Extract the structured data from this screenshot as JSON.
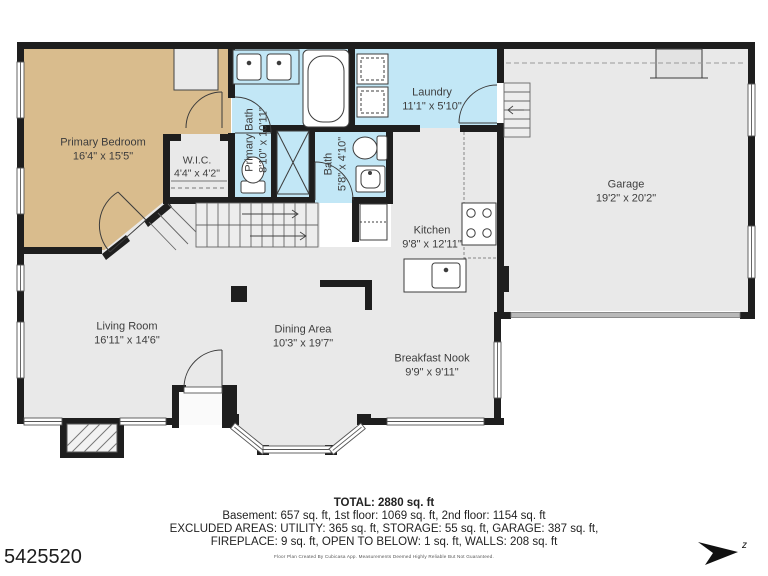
{
  "meta": {
    "mls_number": "5425520",
    "compass_label": "z"
  },
  "rooms": [
    {
      "name": "Primary Bedroom",
      "dims": "16'4\" x 15'5\""
    },
    {
      "name": "W.I.C.",
      "dims": "4'4\" x 4'2\""
    },
    {
      "name": "Primary Bath",
      "dims": "8'10\" x 10'11\""
    },
    {
      "name": "Bath",
      "dims": "5'8\" x 4'10\""
    },
    {
      "name": "Laundry",
      "dims": "11'1\" x 5'10\""
    },
    {
      "name": "Kitchen",
      "dims": "9'8\" x 12'11\""
    },
    {
      "name": "Garage",
      "dims": "19'2\" x 20'2\""
    },
    {
      "name": "Living Room",
      "dims": "16'11\" x 14'6\""
    },
    {
      "name": "Dining Area",
      "dims": "10'3\" x 19'7\""
    },
    {
      "name": "Breakfast Nook",
      "dims": "9'9\" x 9'11\""
    }
  ],
  "summary": {
    "total": "TOTAL: 2880 sq. ft",
    "line1": "Basement: 657 sq. ft, 1st floor: 1069 sq. ft, 2nd floor: 1154 sq. ft",
    "line2": "EXCLUDED AREAS: UTILITY: 365 sq. ft, STORAGE: 55 sq. ft, GARAGE: 387 sq. ft,",
    "line3": "FIREPLACE: 9 sq. ft, OPEN TO BELOW: 1 sq. ft, WALLS: 208 sq. ft",
    "disclaimer": "Floor Plan Created By Cubicasa App. Measurements Deemed Highly Reliable But Not Guaranteed."
  },
  "colors": {
    "bedroom_fill": "#d9bc8d",
    "wet_room_fill": "#c2e7f6",
    "floor_fill": "#e9e9e9",
    "wall": "#1e1e1e"
  }
}
